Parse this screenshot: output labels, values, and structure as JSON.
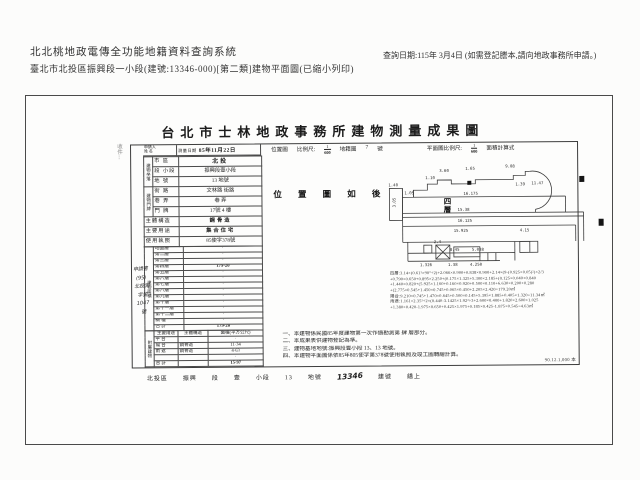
{
  "header": {
    "system_title": "北北桃地政電傳全功能地籍資料查詢系統",
    "doc_line": "臺北市北投區振興段一小段(建號:13346-000)[第二類]建物平面圖(已縮小列印)",
    "query_date": "查詢日期:115年 3月4日 (如需登記謄本,請向地政事務所申請。)"
  },
  "doc": {
    "title": "台北市士林地政事務所建物測量成果圖",
    "margin_note": "收件⋮",
    "stamp_lines": [
      "申請書",
      "(95)",
      "北投測",
      "字第",
      "1047",
      "號"
    ],
    "form": {
      "applicant_label": "申請人",
      "applicant_sub": "姓 名",
      "survey_date_label": "測量日期",
      "survey_date": "85年11月22日",
      "scale_row": {
        "loc_map_label": "位置圖",
        "scale_label": "比例尺:",
        "loc_num": "1",
        "loc_den": "600",
        "cad_label": "地籍圖",
        "cad_no": "7",
        "cad_suffix": "號",
        "plan_scale_label": "平面圖比例尺:",
        "plan_num": "1",
        "plan_den": "600",
        "calc_label": "面積計算式"
      },
      "site_group": "建物坐落",
      "site_rows": [
        {
          "label": "市 區",
          "value": "北投"
        },
        {
          "label": "段 小段",
          "value": "振興段壹小段"
        },
        {
          "label": "地 號",
          "value": "13 地號"
        }
      ],
      "addr_group": "建物門牌",
      "addr_rows": [
        {
          "label": "街 路",
          "value": "文林路 街路"
        },
        {
          "label": "巷 弄",
          "value": "巷 弄"
        },
        {
          "label": "門 牌",
          "value": "17號 4 樓"
        }
      ],
      "info_rows": [
        {
          "label": "主體構造",
          "value": "鋼骨造"
        },
        {
          "label": "主要用途",
          "value": "集合住宅"
        },
        {
          "label": "使用執照",
          "value": "85使字378號"
        }
      ],
      "floors_group": "建物面積",
      "floors_unit": "平方公尺",
      "floor_rows": [
        {
          "label": "地面層",
          "value": "·"
        },
        {
          "label": "第二層",
          "value": "·"
        },
        {
          "label": "第三層",
          "value": "·"
        },
        {
          "label": "第四層",
          "value": "179·20"
        },
        {
          "label": "第五層",
          "value": "·"
        },
        {
          "label": "第六層",
          "value": "·"
        },
        {
          "label": "第七層",
          "value": "·"
        },
        {
          "label": "第八層",
          "value": "·"
        },
        {
          "label": "第九層",
          "value": "·"
        },
        {
          "label": "第十層",
          "value": "·"
        },
        {
          "label": "第十一層",
          "value": "·"
        },
        {
          "label": "第十二層",
          "value": "·"
        },
        {
          "label": "騎 樓",
          "value": "·"
        }
      ],
      "floor_total_label": "合 計",
      "floor_total": "179·20",
      "attached_group": "附屬建物",
      "attached_headers": [
        "主要用途",
        "主體構造",
        "面積(平方公尺)"
      ],
      "attached_rows": [
        {
          "use": "平 台",
          "structure": "",
          "area": "·"
        },
        {
          "use": "陽 台",
          "structure": "鋼骨造",
          "area": "11·34"
        },
        {
          "use": "雨 遮",
          "structure": "鋼骨造",
          "area": "4·63"
        },
        {
          "use": "",
          "structure": "",
          "area": "·"
        },
        {
          "use": "合 計",
          "structure": "",
          "area": "15·97"
        }
      ]
    },
    "location_note": "位 置 圖 如 後",
    "plan": {
      "floor_char_1": "四",
      "floor_char_2": "層",
      "dims": [
        "9.08",
        "1.65",
        "3.60",
        "16.175",
        "15.38",
        "16.125",
        "15.925",
        "4.15",
        "8.45",
        "5.038",
        "2.4",
        "1.38",
        "4.250",
        "1.326",
        "11.47",
        "1.39",
        "1.40",
        "3.05",
        "1.10",
        "1.05"
      ]
    },
    "calc_lines": [
      "四層:3.14×(0.61²×90°÷2)+2.066×0.900+0.838×0.900+2.14×(9-(0.925×0.05)²)×2/3",
      "+0.790×0.650+0.895×2.250+(0.175×1.325+5.300×2.185+(0.125×0.040+0.840",
      "+1.440×0.820+(5.925×1.160+0.160×0.920+0.500×0.110+6.630×0.200+0.280",
      "+(2.775×0.545+1.450×0.745+0.065×0.450+2.205×2.420=179.20㎡",
      "陽台:9.210×0.745+1.470×0.645+0.500×0.145+5.395×1.885+0.405×1.320=11.34㎡",
      "雨遮:1.161×2.35²÷2×(0.440-3.1425×1.92²÷3+2.600×0.400+1.820×2.600×1.025",
      "+1.380×0.420-1.975×0.650+0.425×1.975+0.185×0.425-1.875×0.545=4.63㎡"
    ],
    "notes": [
      "一、本建物係民國85年度建物第一次作價勘測第 肆 層部分。",
      "二、本成果表供建物登記為準。",
      "三、建物基地地號:振興段壹小段 13、13 地號。",
      "四、本建物平面圖係依85年805使字第378號使用執照及竣工圖轉繪計算。"
    ],
    "footer": {
      "tokens": [
        "北投區",
        "振興",
        "段",
        "壹",
        "小段",
        "13",
        "地號",
        "13346",
        "建號",
        "繕上"
      ],
      "print_code": "90.12.1,000 本"
    }
  }
}
